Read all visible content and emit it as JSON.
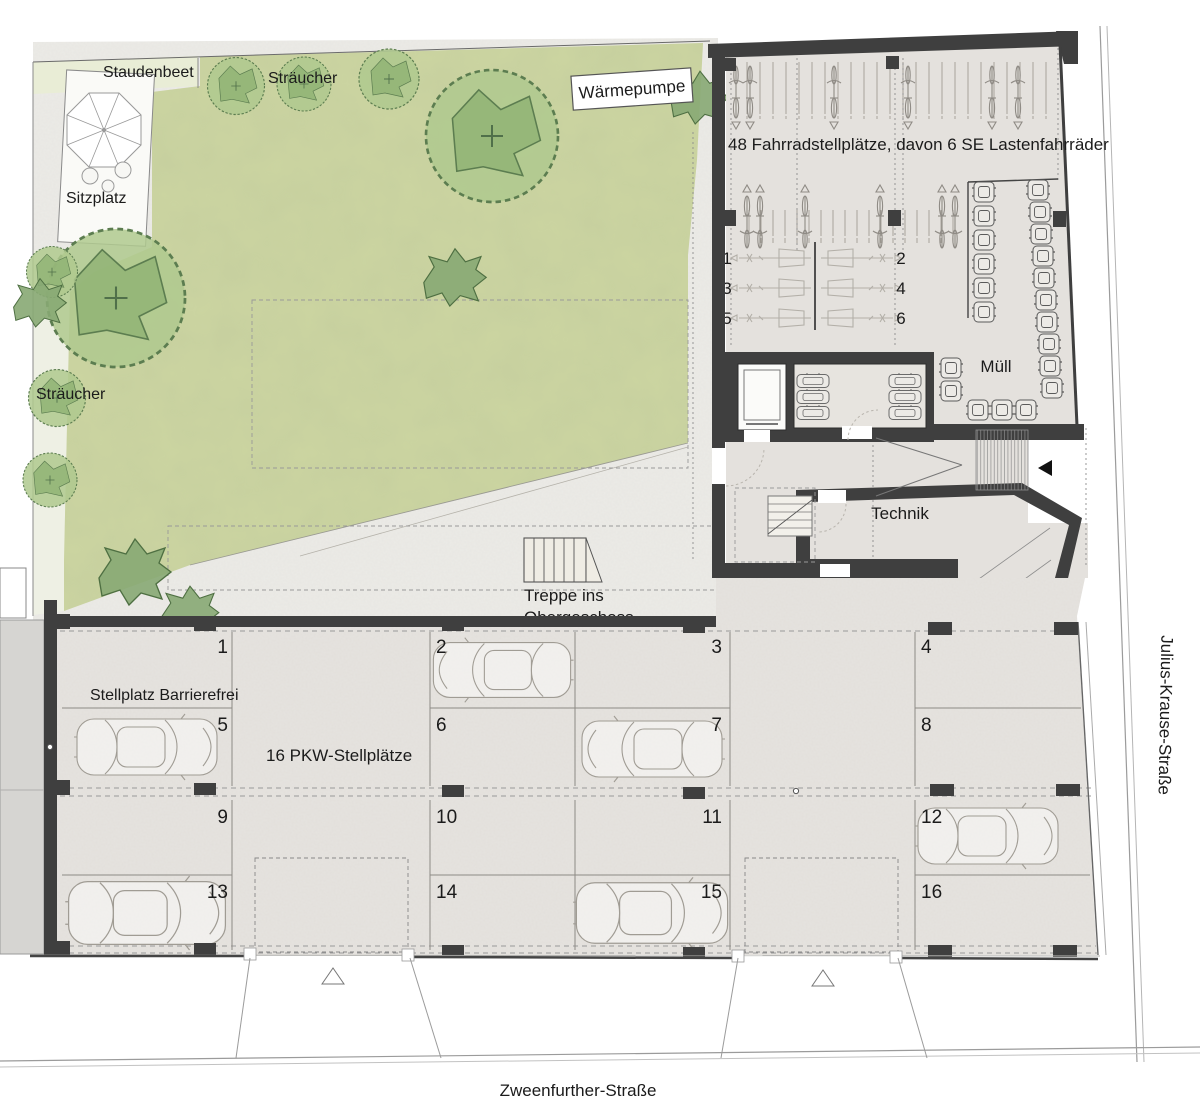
{
  "plan": {
    "garden": {
      "staudenbeet": "Staudenbeet",
      "shrubs_top": "Sträucher",
      "shrubs_left": "Sträucher",
      "seating": "Sitzplatz",
      "heat_pump": "Wärmepumpe"
    },
    "bike_area": {
      "label": "48 Fahrradstellplätze, davon 6 SE Lastenfahrräder",
      "cargo_spots": [
        "1",
        "2",
        "3",
        "4",
        "5",
        "6"
      ],
      "waste_label": "Müll"
    },
    "building": {
      "technik": "Technik",
      "stairs_line1": "Treppe ins",
      "stairs_line2": "Obergeschoss"
    },
    "parking": {
      "label": "16 PKW-Stellplätze",
      "accessible_label": "Stellplatz Barrierefrei",
      "spots": [
        "1",
        "2",
        "3",
        "4",
        "5",
        "6",
        "7",
        "8",
        "9",
        "10",
        "11",
        "12",
        "13",
        "14",
        "15",
        "16"
      ]
    },
    "streets": {
      "right": "Julius-Krause-Straße",
      "bottom": "Zweenfurther-Straße"
    },
    "colors": {
      "lawn": "#ccd5a1",
      "concrete": "#ecebe7",
      "parking_floor": "#e6e3df",
      "bike_floor": "#e4e1dd",
      "wall": "#3f3f3f",
      "neighbor": "#d6d5d2",
      "pale_band": "#eef0e4",
      "bed_strip": "#e9edd6"
    }
  }
}
